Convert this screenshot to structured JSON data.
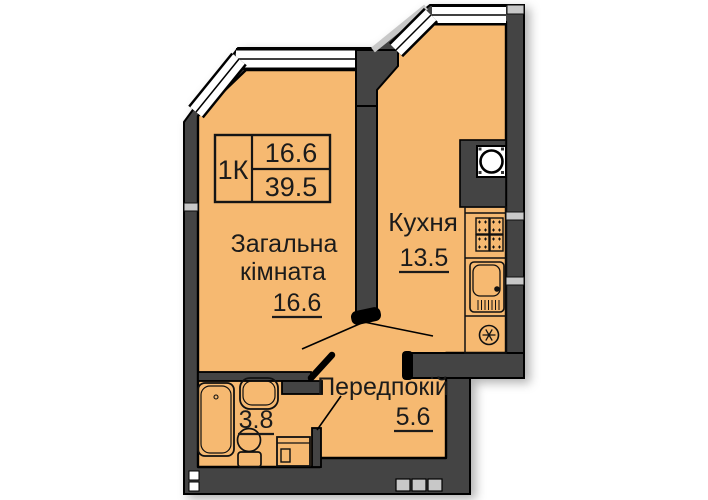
{
  "plan": {
    "info_box": {
      "type_label": "1К",
      "living_area": "16.6",
      "total_area": "39.5"
    },
    "rooms": {
      "living": {
        "name_line1": "Загальна",
        "name_line2": "кімната",
        "area": "16.6"
      },
      "kitchen": {
        "name": "Кухня",
        "area": "13.5"
      },
      "hallway": {
        "name": "Передпокій",
        "area": "5.6"
      },
      "bathroom": {
        "area": "3.8"
      }
    },
    "fixtures": {
      "kitchen": [
        "washing-machine",
        "stove",
        "sink",
        "ventilation"
      ],
      "bathroom": [
        "bathtub",
        "washbasin",
        "toilet",
        "washing-machine"
      ]
    },
    "colors": {
      "floor": "#F6B971",
      "wall": "#444444",
      "outline": "#000000",
      "window": "#FFFFFF",
      "fitting_gray": "#C8C8C8",
      "text": "#1B1B1B"
    }
  }
}
